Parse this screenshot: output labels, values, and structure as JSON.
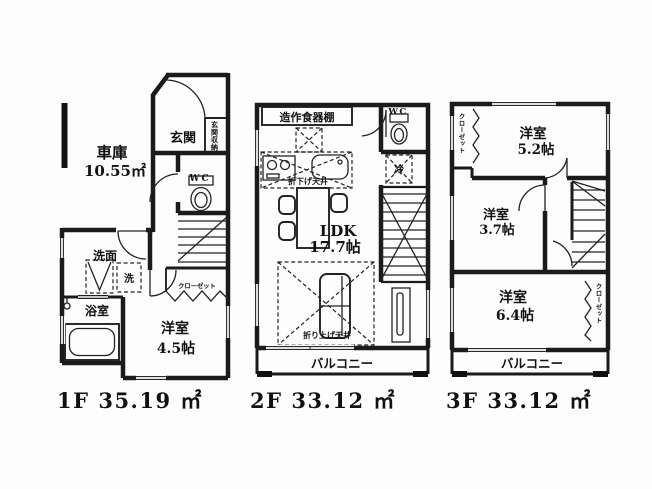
{
  "page": {
    "background": "#fdfdfd",
    "line_color": "#1b1b1b"
  },
  "floor1": {
    "area_label": "1F 35.19 ㎡",
    "garage": "車庫",
    "garage_area": "10.55㎡",
    "entrance": "玄関",
    "entrance_storage": "玄関収納",
    "wc": "WC",
    "washroom": "洗面",
    "washer": "洗",
    "bath": "浴室",
    "closet": "クローゼット",
    "bedroom": "洋室",
    "bedroom_size": "4.5帖"
  },
  "floor2": {
    "area_label": "2F 33.12 ㎡",
    "cupboard": "造作食器棚",
    "wc": "WC",
    "lowered_ceiling": "折下げ天井",
    "fridge": "冷",
    "ldk": "LDK",
    "ldk_size": "17.7帖",
    "raised_ceiling": "折り上げ天井",
    "balcony": "バルコニー"
  },
  "floor3": {
    "area_label": "3F 33.12 ㎡",
    "closet_top": "クローゼット",
    "bedroom1": "洋室",
    "bedroom1_size": "5.2帖",
    "bedroom2": "洋室",
    "bedroom2_size": "3.7帖",
    "bedroom3": "洋室",
    "bedroom3_size": "6.4帖",
    "closet_right": "クローゼット",
    "balcony": "バルコニー"
  }
}
